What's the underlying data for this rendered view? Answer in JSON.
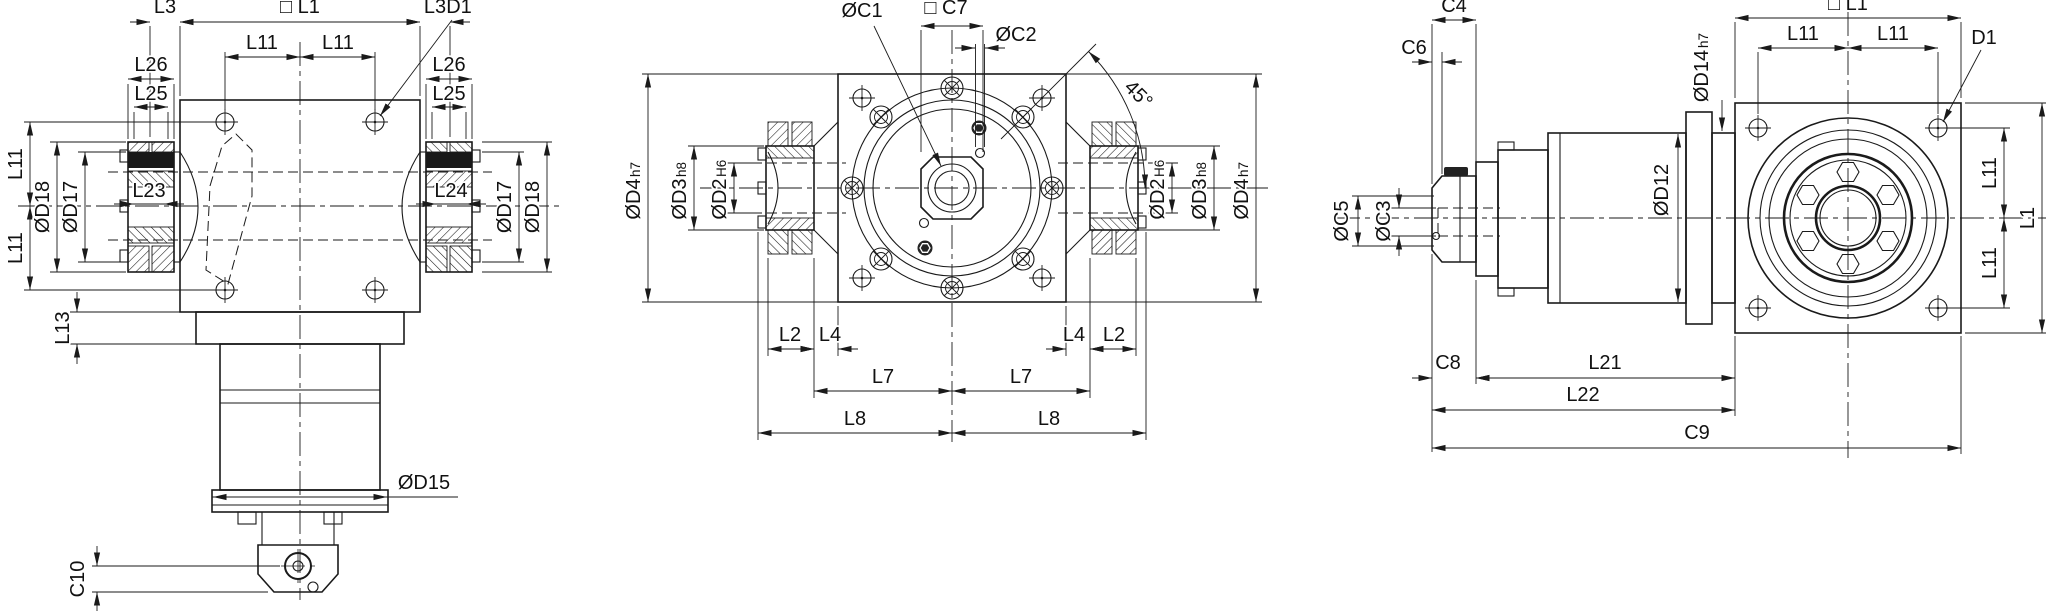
{
  "front_view": {
    "labels": {
      "l3_left": "L3",
      "l1_square": "□ L1",
      "l3_right": "L3",
      "d1": "D1",
      "l11_top_left": "L11",
      "l11_top_right": "L11",
      "l26_left": "L26",
      "l25_left": "L25",
      "l26_right": "L26",
      "l25_right": "L25",
      "l23": "L23",
      "l24": "L24",
      "l11_side_upper": "L11",
      "l11_side_lower": "L11",
      "d18_left": "ØD18",
      "d17_left": "ØD17",
      "d17_right": "ØD17",
      "d18_right": "ØD18",
      "l13": "L13",
      "d15": "ØD15",
      "c10": "C10"
    }
  },
  "side_view": {
    "labels": {
      "c1": "ØC1",
      "c7_square": "□ C7",
      "c2": "ØC2",
      "angle": "45°",
      "d4": "ØD4",
      "d4_tol": "h7",
      "d3": "ØD3",
      "d3_tol": "h8",
      "d2": "ØD2",
      "d2_tol": "H6",
      "l2": "L2",
      "l4": "L4",
      "l7": "L7",
      "l8": "L8"
    }
  },
  "output_view": {
    "labels": {
      "c4": "C4",
      "c6": "C6",
      "l1_square": "□ L1",
      "l11_top_left": "L11",
      "l11_top_right": "L11",
      "d1": "D1",
      "d14": "ØD14",
      "d14_tol": "h7",
      "c5": "ØC5",
      "c3": "ØC3",
      "d12": "ØD12",
      "l11_side_upper": "L11",
      "l11_side_lower": "L11",
      "l1_side": "L1",
      "c8": "C8",
      "l21": "L21",
      "l22": "L22",
      "c9": "C9"
    }
  }
}
